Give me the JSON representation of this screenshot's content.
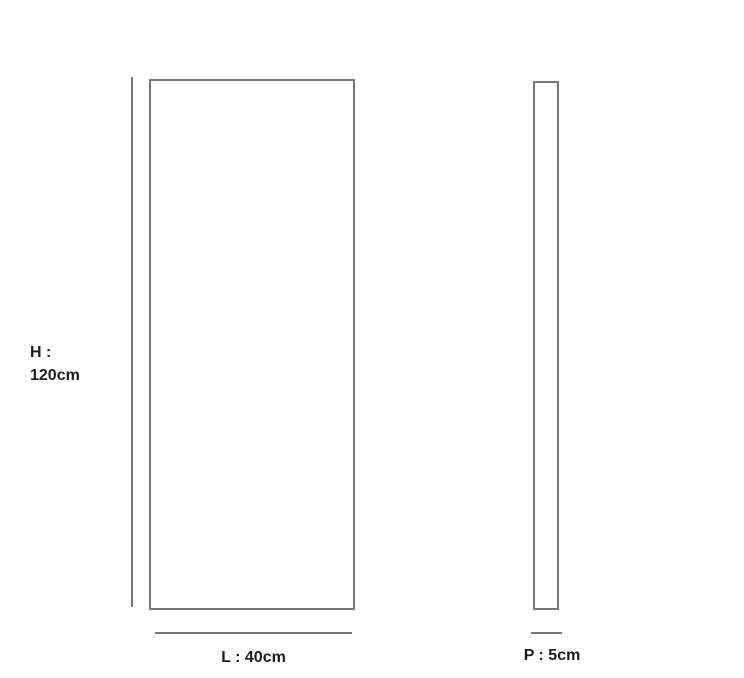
{
  "diagram": {
    "colors": {
      "background": "#ffffff",
      "line": "#767676",
      "text": "#1c1c1c"
    },
    "height_label_line1": "H :",
    "height_label_line2": "120cm",
    "length_label": "L : 40cm",
    "depth_label": "P : 5cm",
    "dimensions": {
      "height_cm": 120,
      "length_cm": 40,
      "depth_cm": 5
    }
  }
}
